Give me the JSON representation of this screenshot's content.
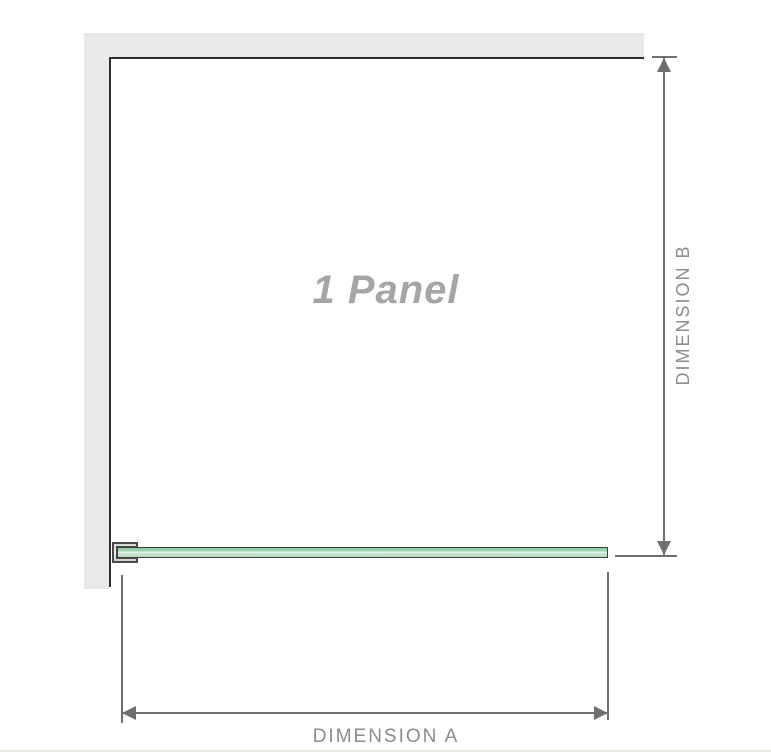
{
  "diagram": {
    "panel_label": "1 Panel",
    "dimension_a_label": "DIMENSION A",
    "dimension_b_label": "DIMENSION B"
  },
  "colors": {
    "wall_fill": "#e9e9e9",
    "wall_edge": "#2e2e2e",
    "glass_outline": "#3e3e3e",
    "glass_green_dark": "#8fc9a4",
    "glass_green_highlight": "#e8f5ec",
    "glass_green_light": "#b4dbc0",
    "bracket_fill": "#d6d6d6",
    "bracket_outline": "#4a4a4a",
    "dimension_line": "#6f6f6f",
    "dimension_label_text": "#8c8c8c",
    "panel_label_text": "#a5a5a5",
    "bottom_rule": "#eae7e1"
  }
}
